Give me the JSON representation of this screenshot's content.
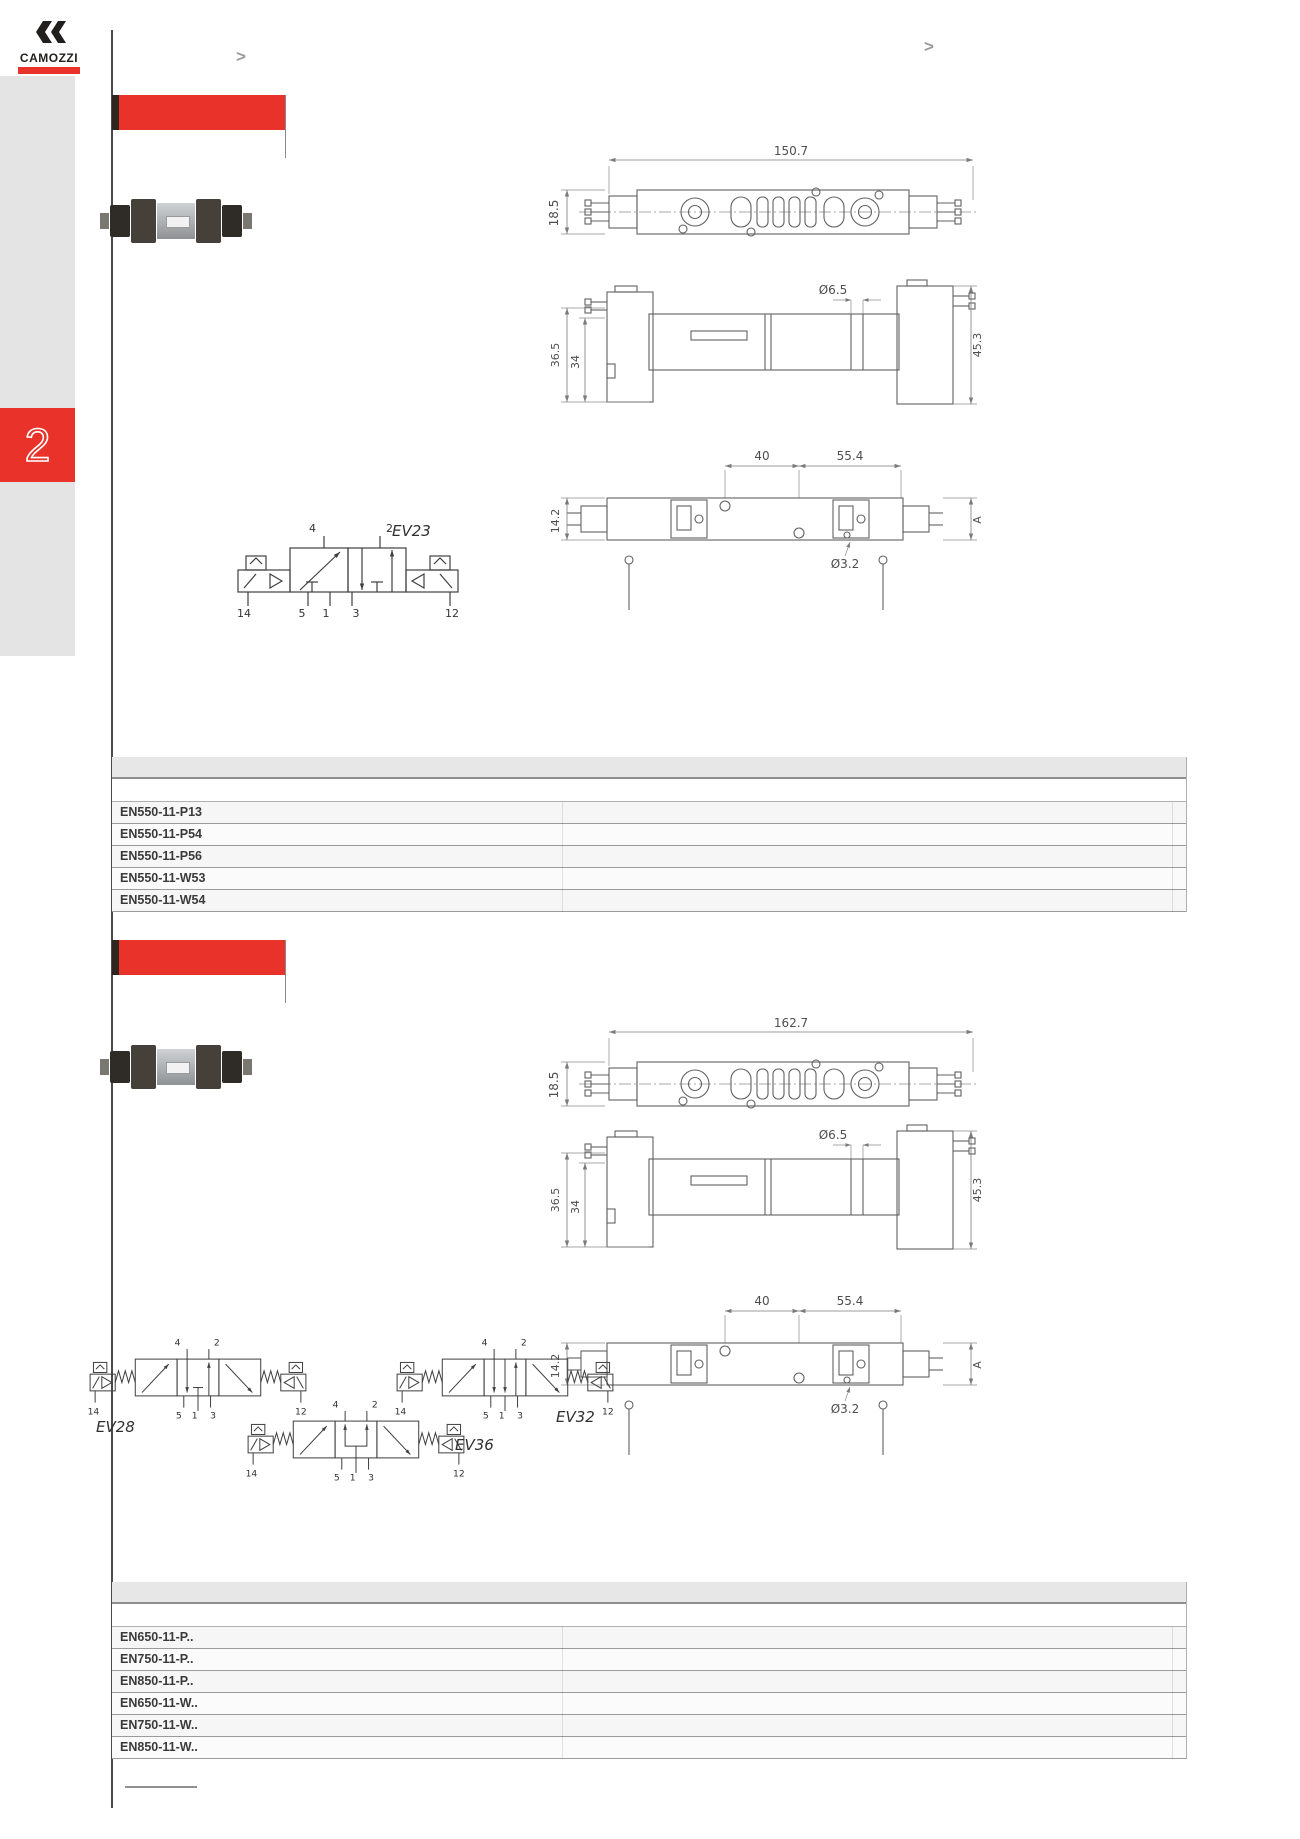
{
  "header": {
    "brand": "CAMOZZI",
    "chevron_left": ">",
    "chevron_right": ">"
  },
  "sidebar": {
    "chapter_tab": "2"
  },
  "sections": [
    {
      "models": [
        "EN550-11-P13",
        "EN550-11-P54",
        "EN550-11-P56",
        "EN550-11-W53",
        "EN550-11-W54"
      ],
      "dims": {
        "overall_width": "150.7",
        "overall_height": "18.5",
        "hole_top": "Ø6.5",
        "height_outer": "36.5",
        "height_inner": "34",
        "height_right": "45.3",
        "pitch_left": "40",
        "pitch_right": "55.4",
        "base_height": "14.2",
        "ref_letter": "A",
        "hole_bottom": "Ø3.2"
      },
      "symbols": [
        {
          "label": "EV23",
          "ports": [
            "4",
            "2",
            "14",
            "5",
            "1",
            "3",
            "12"
          ]
        }
      ]
    },
    {
      "models": [
        "EN650-11-P..",
        "EN750-11-P..",
        "EN850-11-P..",
        "EN650-11-W..",
        "EN750-11-W..",
        "EN850-11-W.."
      ],
      "dims": {
        "overall_width": "162.7",
        "overall_height": "18.5",
        "hole_top": "Ø6.5",
        "height_outer": "36.5",
        "height_inner": "34",
        "height_right": "45.3",
        "pitch_left": "40",
        "pitch_right": "55.4",
        "base_height": "14.2",
        "ref_letter": "A",
        "hole_bottom": "Ø3.2"
      },
      "symbols": [
        {
          "label": "EV28",
          "ports": [
            "4",
            "2",
            "14",
            "5",
            "1",
            "3",
            "12"
          ]
        },
        {
          "label": "EV32",
          "ports": [
            "4",
            "2",
            "14",
            "5",
            "1",
            "3",
            "12"
          ]
        },
        {
          "label": "EV36",
          "ports": [
            "4",
            "2",
            "14",
            "5",
            "1",
            "3",
            "12"
          ]
        }
      ]
    }
  ]
}
